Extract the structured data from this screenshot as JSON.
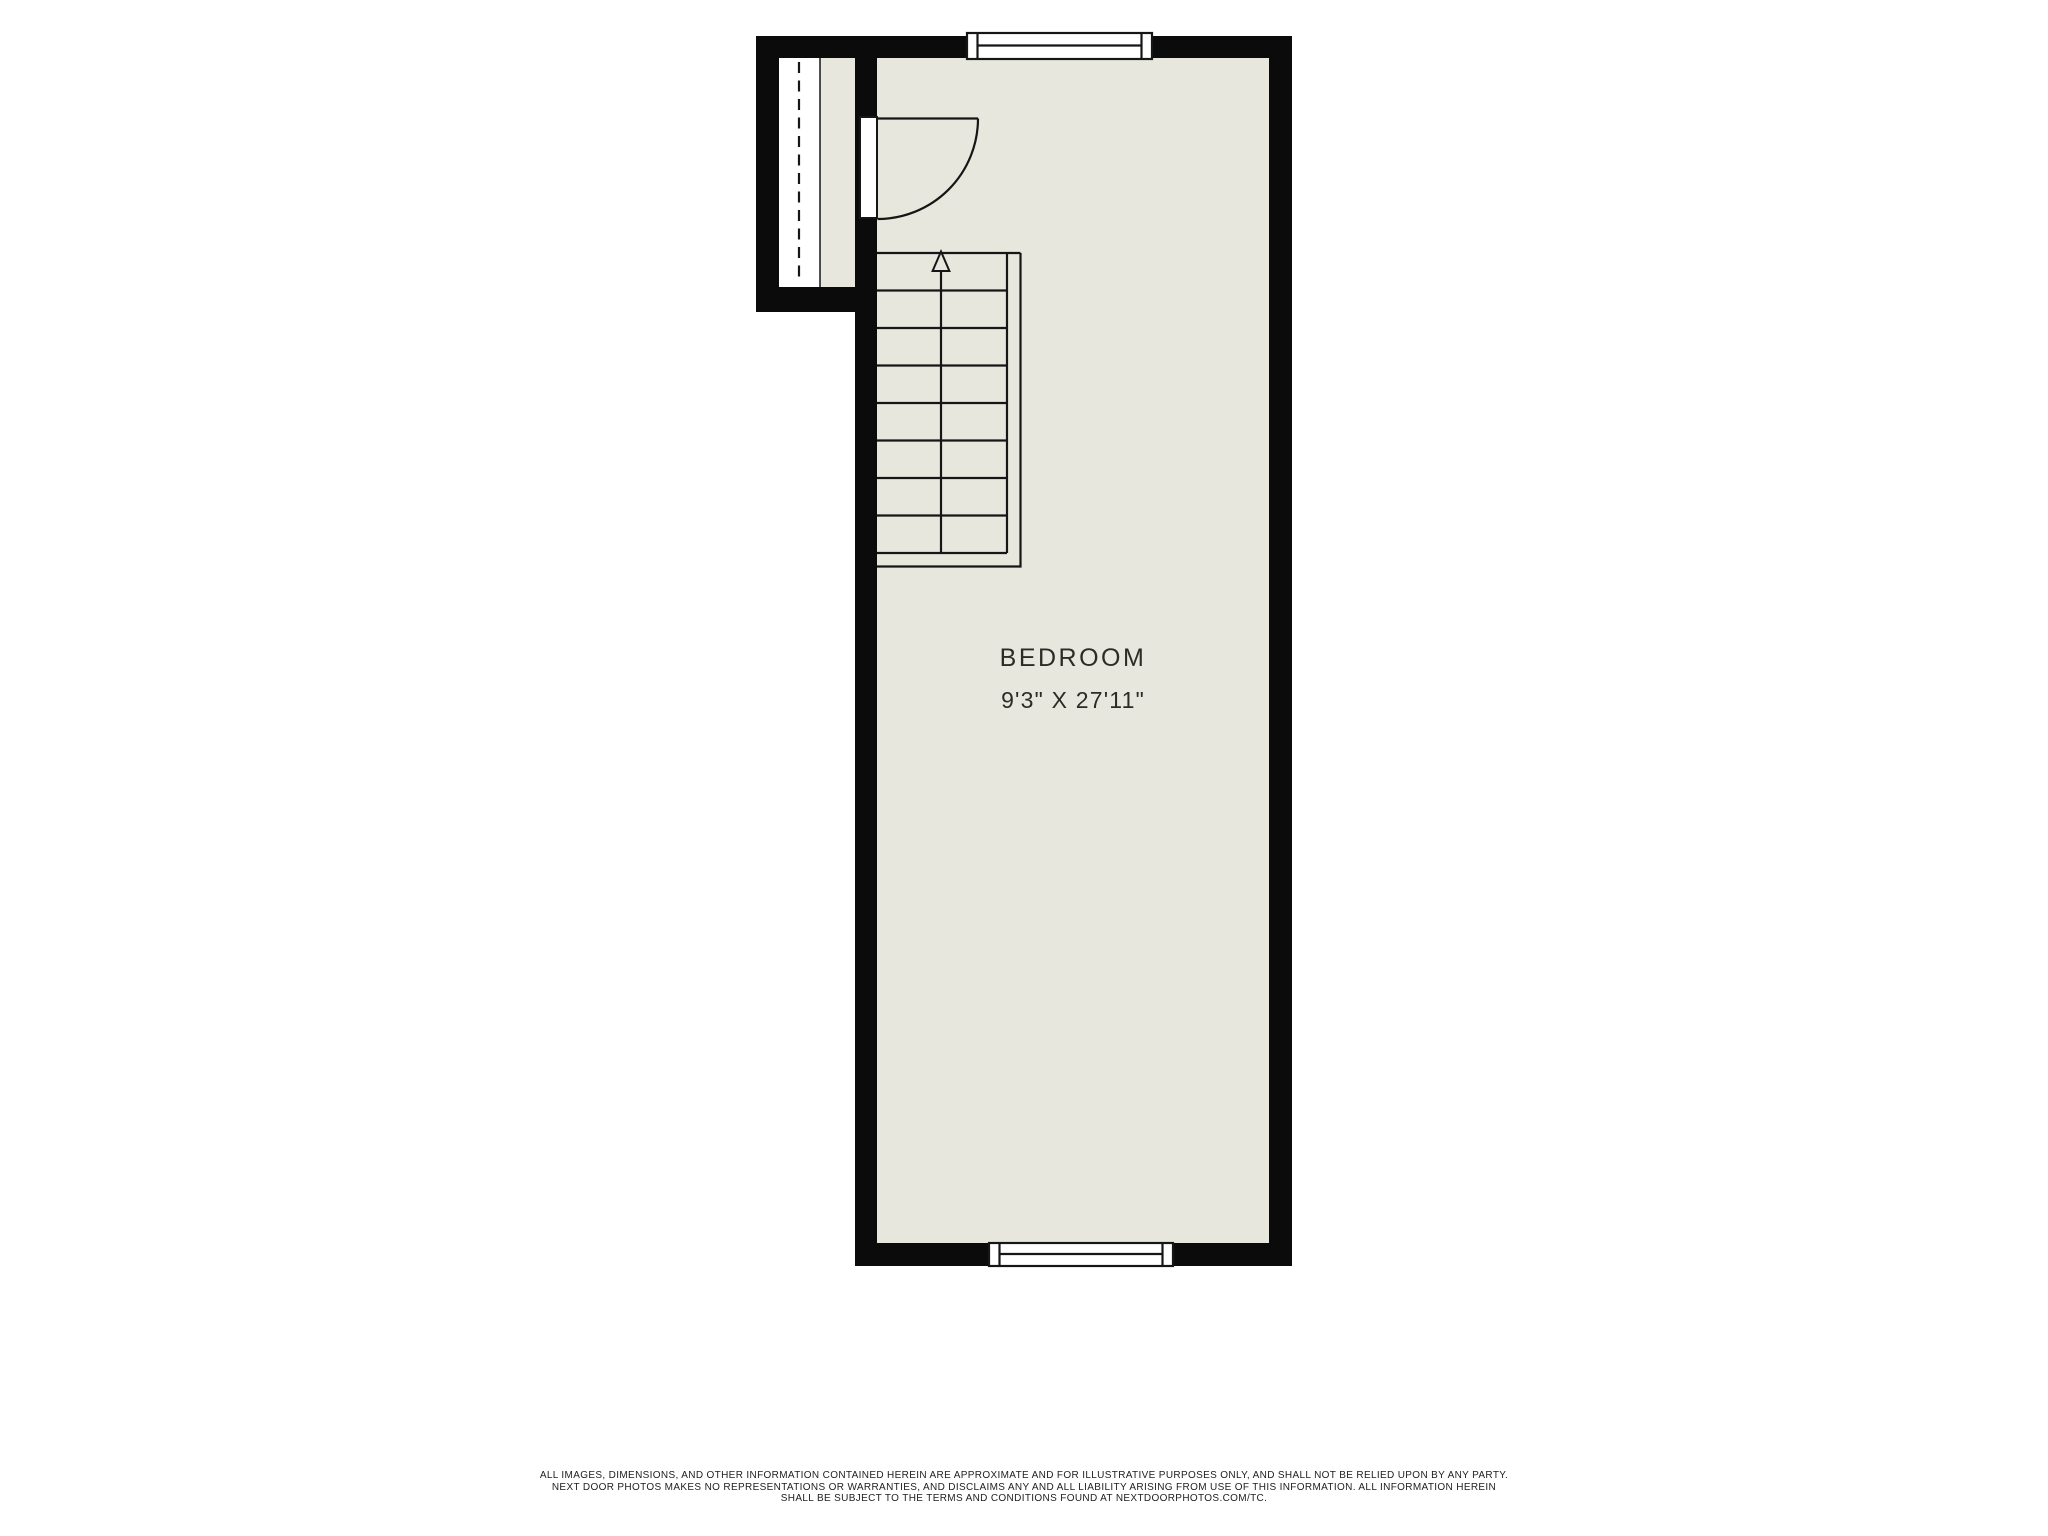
{
  "floorplan": {
    "room": {
      "label": "BEDROOM",
      "dimensions": "9'3\" X 27'11\""
    },
    "stairs": {
      "visible_tread_rows": 8,
      "direction_arrow": "up"
    },
    "features": {
      "windows": 2,
      "doors": 1,
      "door_swing": "quarter-circle into room"
    }
  },
  "disclaimer": {
    "lines": [
      "ALL IMAGES, DIMENSIONS, AND OTHER INFORMATION CONTAINED HEREIN ARE APPROXIMATE AND FOR ILLUSTRATIVE PURPOSES ONLY, AND SHALL NOT BE RELIED UPON BY ANY PARTY.",
      "NEXT DOOR PHOTOS MAKES NO REPRESENTATIONS OR WARRANTIES, AND DISCLAIMS ANY AND ALL LIABILITY ARISING FROM USE OF THIS INFORMATION. ALL INFORMATION HEREIN",
      "SHALL BE SUBJECT TO THE TERMS AND CONDITIONS FOUND AT NEXTDOORPHOTOS.COM/TC."
    ]
  },
  "colors": {
    "wall": "#0b0b0b",
    "floor": "#e8e7de",
    "line": "#161616",
    "room_label_text": "#2d2b26",
    "disclaimer_text": "#1e1e1e",
    "background": "#ffffff"
  }
}
